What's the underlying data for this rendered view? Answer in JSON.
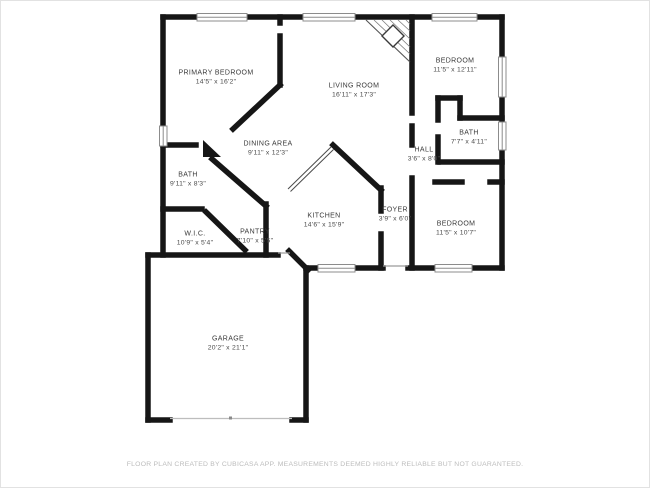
{
  "floor_plan": {
    "rooms": [
      {
        "name": "PRIMARY BEDROOM",
        "dimensions": "14'5\" x 16'2\"",
        "cx": 216,
        "cy": 78
      },
      {
        "name": "LIVING ROOM",
        "dimensions": "16'11\" x 17'3\"",
        "cx": 354,
        "cy": 91
      },
      {
        "name": "BEDROOM",
        "dimensions": "11'5\" x 12'11\"",
        "cx": 455,
        "cy": 66
      },
      {
        "name": "BATH",
        "dimensions": "7'7\" x 4'11\"",
        "cx": 469,
        "cy": 138
      },
      {
        "name": "HALL",
        "dimensions": "3'6\" x 8'0\"",
        "cx": 424,
        "cy": 155
      },
      {
        "name": "DINING AREA",
        "dimensions": "9'11\" x 12'3\"",
        "cx": 268,
        "cy": 149
      },
      {
        "name": "BATH",
        "dimensions": "9'11\" x 8'3\"",
        "cx": 188,
        "cy": 180
      },
      {
        "name": "W.I.C.",
        "dimensions": "10'9\" x 5'4\"",
        "cx": 195,
        "cy": 239
      },
      {
        "name": "PANTRY",
        "dimensions": "7'10\" x 5'5\"",
        "cx": 255,
        "cy": 237
      },
      {
        "name": "KITCHEN",
        "dimensions": "14'6\" x 15'9\"",
        "cx": 324,
        "cy": 221
      },
      {
        "name": "FOYER",
        "dimensions": "3'9\" x 6'0\"",
        "cx": 395,
        "cy": 215
      },
      {
        "name": "BEDROOM",
        "dimensions": "11'5\" x 10'7\"",
        "cx": 456,
        "cy": 229
      },
      {
        "name": "GARAGE",
        "dimensions": "20'2\" x 21'1\"",
        "cx": 228,
        "cy": 344
      }
    ],
    "footer": "FLOOR PLAN CREATED BY CUBICASA APP. MEASUREMENTS DEEMED HIGHLY RELIABLE BUT NOT GUARANTEED.",
    "colors": {
      "wall": "#161616",
      "label_text": "#3a3a3a",
      "footer_text": "#bcbcbc",
      "window_frame": "#8c8c8c"
    }
  }
}
